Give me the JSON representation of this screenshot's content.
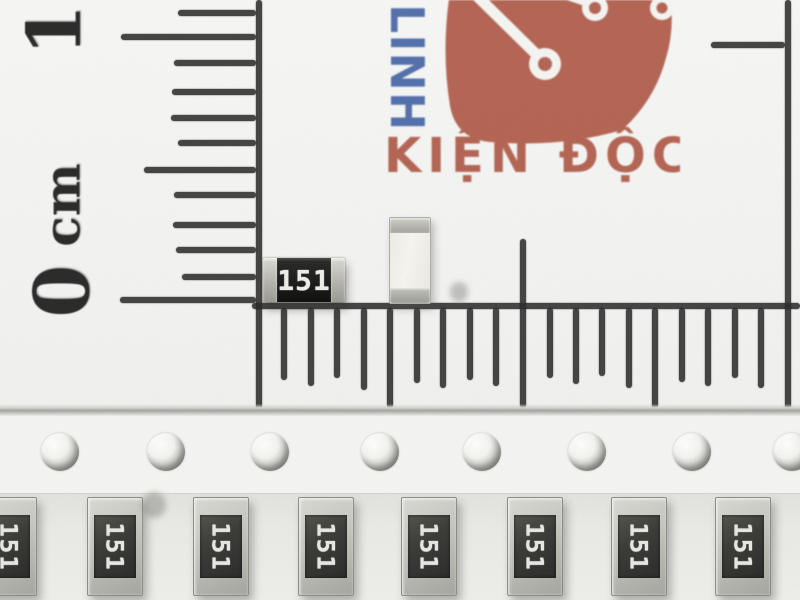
{
  "colors": {
    "ink": "#2e2e2e",
    "logo_red": "#b25d4b",
    "logo_blue": "#4a68a8",
    "paper": "#f6f7f4",
    "resistor_body": "#1f1f1d",
    "cap_silver": "#c6c6c0",
    "marking_white": "#efefec"
  },
  "ruler": {
    "labels": {
      "one": "1",
      "zero": "0",
      "unit": "cm"
    },
    "vertical": {
      "line_x": 256,
      "ticks": [
        {
          "y": 13,
          "len": 78
        },
        {
          "y": 37,
          "len": 135
        },
        {
          "y": 63,
          "len": 82
        },
        {
          "y": 92,
          "len": 84
        },
        {
          "y": 118,
          "len": 85
        },
        {
          "y": 143,
          "len": 78
        },
        {
          "y": 170,
          "len": 112
        },
        {
          "y": 195,
          "len": 82
        },
        {
          "y": 225,
          "len": 83
        },
        {
          "y": 250,
          "len": 80
        },
        {
          "y": 277,
          "len": 74
        },
        {
          "y": 300,
          "len": 136
        }
      ]
    },
    "horizontal": {
      "line_y": 305,
      "ticks": [
        {
          "x": 284,
          "len": 72
        },
        {
          "x": 311,
          "len": 78
        },
        {
          "x": 337,
          "len": 70
        },
        {
          "x": 364,
          "len": 82
        },
        {
          "x": 390,
          "len": 100
        },
        {
          "x": 417,
          "len": 75
        },
        {
          "x": 443,
          "len": 80
        },
        {
          "x": 470,
          "len": 72
        },
        {
          "x": 496,
          "len": 78
        },
        {
          "x": 523,
          "len": 100,
          "up": 66
        },
        {
          "x": 550,
          "len": 70
        },
        {
          "x": 576,
          "len": 76
        },
        {
          "x": 602,
          "len": 68
        },
        {
          "x": 629,
          "len": 80
        },
        {
          "x": 655,
          "len": 100
        },
        {
          "x": 682,
          "len": 74
        },
        {
          "x": 708,
          "len": 78
        },
        {
          "x": 735,
          "len": 70
        },
        {
          "x": 761,
          "len": 80
        }
      ]
    },
    "right_line": {
      "x": 785,
      "tick_y": 42,
      "tick_len": 74
    }
  },
  "logo": {
    "vertical_text": "LINH",
    "main_text": "KIỆN ĐỘC"
  },
  "components": {
    "loose_resistor": {
      "marking": "151"
    }
  },
  "tape": {
    "hole_y": 452,
    "holes": [
      {
        "x": 60
      },
      {
        "x": 166
      },
      {
        "x": 270
      },
      {
        "x": 380
      },
      {
        "x": 482
      },
      {
        "x": 587
      },
      {
        "x": 692
      },
      {
        "x": 792,
        "dark": true
      }
    ],
    "resistor_y": 497,
    "resistors": [
      {
        "x": 8,
        "marking": "151"
      },
      {
        "x": 114,
        "marking": "151"
      },
      {
        "x": 220,
        "marking": "151"
      },
      {
        "x": 325,
        "marking": "151"
      },
      {
        "x": 428,
        "marking": "151"
      },
      {
        "x": 534,
        "marking": "151"
      },
      {
        "x": 638,
        "marking": "151"
      },
      {
        "x": 742,
        "marking": "151"
      }
    ]
  }
}
